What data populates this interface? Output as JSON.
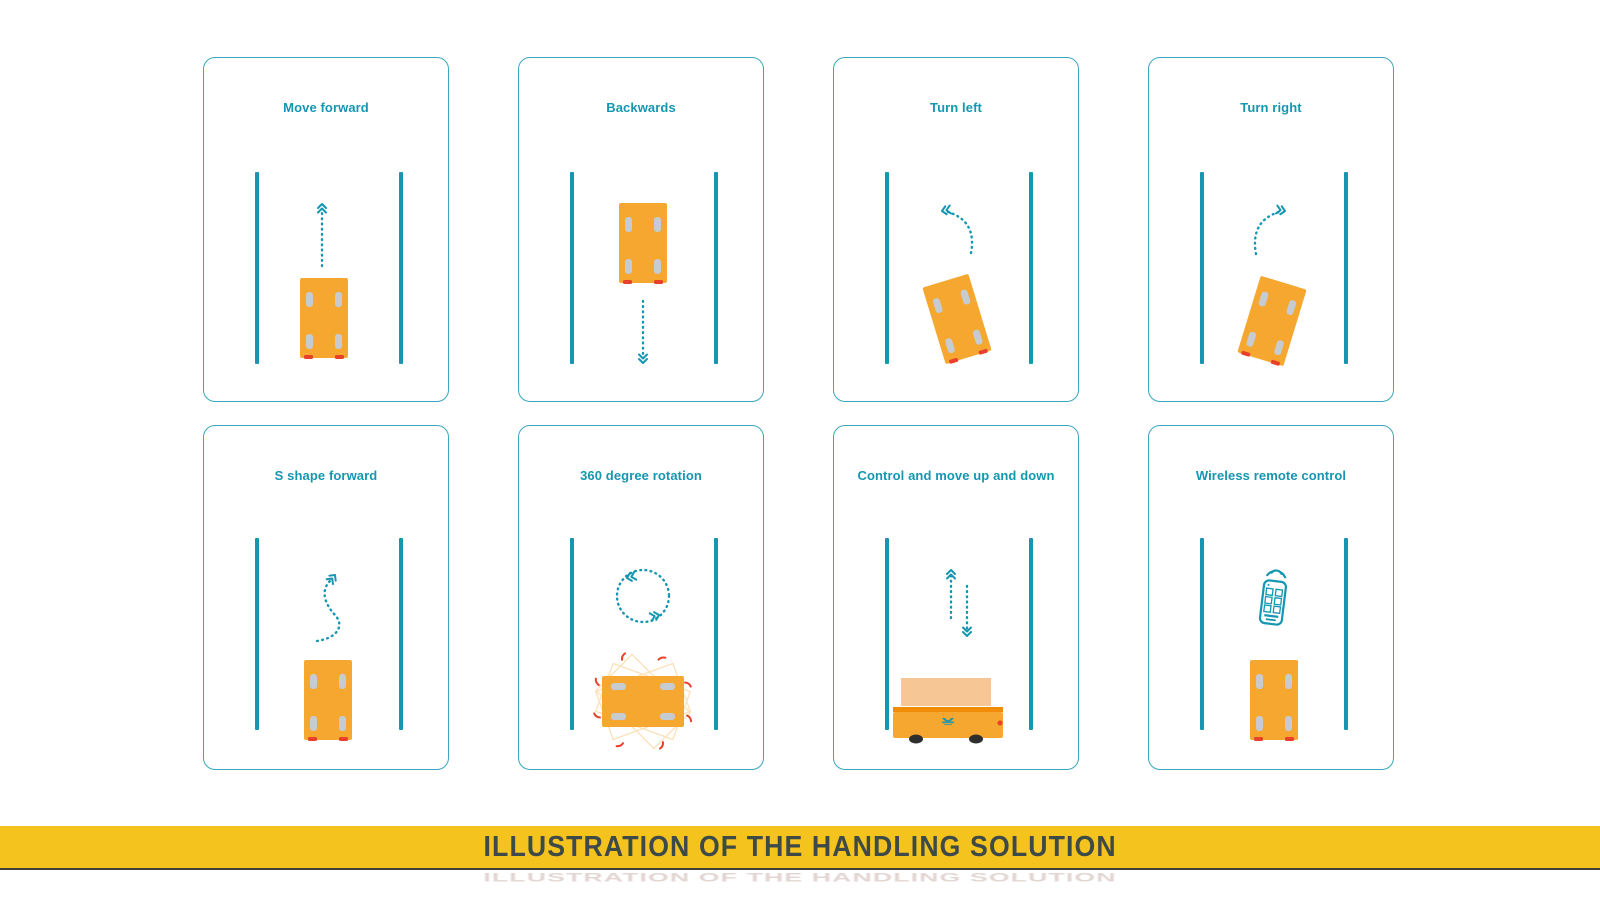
{
  "colors": {
    "page_bg": "#FFFFFF",
    "teal": "#1596B1",
    "card_border": "#3AA7BE",
    "orange": "#F5A72F",
    "orange_light": "#F6C795",
    "orange_dark": "#F08C05",
    "red": "#E8402A",
    "wheel_gray": "#C6CBD1",
    "wheel_dark": "#2F2F2F",
    "banner_bg": "#F5C31D",
    "banner_text": "#3E4A48"
  },
  "panels": [
    {
      "id": "move-forward",
      "title": "Move forward"
    },
    {
      "id": "backwards",
      "title": "Backwards"
    },
    {
      "id": "turn-left",
      "title": "Turn left"
    },
    {
      "id": "turn-right",
      "title": "Turn right"
    },
    {
      "id": "s-shape-forward",
      "title": "S shape forward"
    },
    {
      "id": "rotation-360",
      "title": "360 degree rotation"
    },
    {
      "id": "up-down",
      "title": "Control and move up and down"
    },
    {
      "id": "wireless-remote",
      "title": "Wireless remote control"
    }
  ],
  "banner": {
    "title": "ILLUSTRATION OF THE HANDLING SOLUTION"
  }
}
